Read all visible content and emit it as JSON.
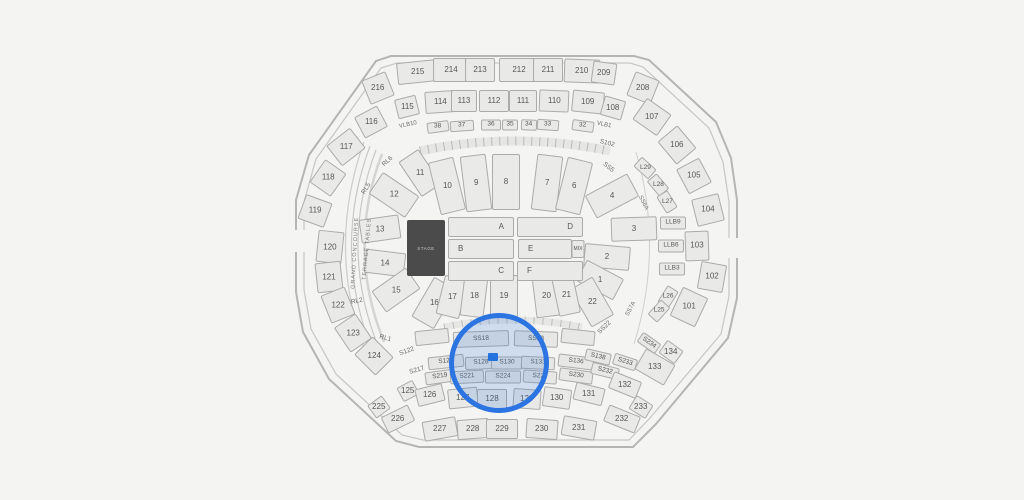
{
  "canvas": {
    "width": 1024,
    "height": 500,
    "background": "#f4f4f3"
  },
  "colors": {
    "section_fill": "#e9e9e8",
    "section_border": "#ababab",
    "label_color": "#565656",
    "stage_fill": "#4b4b4b",
    "stage_text": "#c9c9c9",
    "highlight_blue": "#2b74e2",
    "highlight_tint": "rgba(59,123,213,0.20)",
    "selected_fill": "#1e6fe3"
  },
  "map": {
    "stage": {
      "label": "STAGE",
      "x": 426,
      "y": 248,
      "w": 38,
      "h": 56
    },
    "selection": {
      "circle": {
        "cx": 494,
        "cy": 358,
        "r": 45,
        "stroke_w": 5
      },
      "marker": {
        "x": 493,
        "y": 357,
        "w": 10,
        "h": 8
      }
    },
    "sections": [
      {
        "n": "216",
        "x": 378,
        "y": 88,
        "w": 26,
        "h": 26,
        "r": -22,
        "t": "o"
      },
      {
        "n": "215",
        "x": 418,
        "y": 72,
        "w": 42,
        "h": 22,
        "r": -6,
        "t": "o"
      },
      {
        "n": "214",
        "x": 451,
        "y": 70,
        "w": 36,
        "h": 24,
        "r": 0,
        "t": "o"
      },
      {
        "n": "213",
        "x": 480,
        "y": 70,
        "w": 30,
        "h": 24,
        "r": 0,
        "t": "o"
      },
      {
        "n": "212",
        "x": 519,
        "y": 70,
        "w": 40,
        "h": 24,
        "r": 0,
        "t": "o"
      },
      {
        "n": "211",
        "x": 548,
        "y": 70,
        "w": 30,
        "h": 24,
        "r": 0,
        "t": "o"
      },
      {
        "n": "210",
        "x": 582,
        "y": 71,
        "w": 36,
        "h": 24,
        "r": 2,
        "t": "o"
      },
      {
        "n": "209",
        "x": 604,
        "y": 73,
        "w": 24,
        "h": 22,
        "r": 8,
        "t": "o"
      },
      {
        "n": "208",
        "x": 643,
        "y": 88,
        "w": 26,
        "h": 26,
        "r": 22,
        "t": "o"
      },
      {
        "n": "115",
        "x": 407,
        "y": 107,
        "w": 22,
        "h": 20,
        "r": -14,
        "t": "o"
      },
      {
        "n": "114",
        "x": 440,
        "y": 102,
        "w": 30,
        "h": 22,
        "r": -4,
        "t": "o"
      },
      {
        "n": "113",
        "x": 464,
        "y": 101,
        "w": 26,
        "h": 22,
        "r": 0,
        "t": "o"
      },
      {
        "n": "112",
        "x": 494,
        "y": 101,
        "w": 30,
        "h": 22,
        "r": 0,
        "t": "o"
      },
      {
        "n": "111",
        "x": 523,
        "y": 101,
        "w": 28,
        "h": 22,
        "r": 0,
        "t": "o"
      },
      {
        "n": "110",
        "x": 554,
        "y": 101,
        "w": 30,
        "h": 22,
        "r": 2,
        "t": "o"
      },
      {
        "n": "109",
        "x": 588,
        "y": 102,
        "w": 32,
        "h": 22,
        "r": 6,
        "t": "o"
      },
      {
        "n": "108",
        "x": 613,
        "y": 108,
        "w": 22,
        "h": 20,
        "r": 16,
        "t": "o"
      },
      {
        "n": "38",
        "x": 438,
        "y": 127,
        "w": 22,
        "h": 11,
        "r": -8,
        "t": "l"
      },
      {
        "n": "37",
        "x": 462,
        "y": 126,
        "w": 24,
        "h": 11,
        "r": -4,
        "t": "l"
      },
      {
        "n": "36",
        "x": 491,
        "y": 125,
        "w": 20,
        "h": 11,
        "r": 0,
        "t": "l"
      },
      {
        "n": "35",
        "x": 510,
        "y": 125,
        "w": 16,
        "h": 11,
        "r": 0,
        "t": "l"
      },
      {
        "n": "34",
        "x": 529,
        "y": 125,
        "w": 16,
        "h": 11,
        "r": 2,
        "t": "l"
      },
      {
        "n": "33",
        "x": 548,
        "y": 125,
        "w": 22,
        "h": 11,
        "r": 4,
        "t": "l"
      },
      {
        "n": "32",
        "x": 583,
        "y": 126,
        "w": 22,
        "h": 11,
        "r": 8,
        "t": "l"
      },
      {
        "n": "116",
        "x": 371,
        "y": 122,
        "w": 26,
        "h": 24,
        "r": -28,
        "t": "o"
      },
      {
        "n": "117",
        "x": 346,
        "y": 147,
        "w": 30,
        "h": 26,
        "r": -38,
        "t": "o"
      },
      {
        "n": "118",
        "x": 328,
        "y": 178,
        "w": 28,
        "h": 26,
        "r": -55,
        "t": "o"
      },
      {
        "n": "119",
        "x": 315,
        "y": 211,
        "w": 26,
        "h": 28,
        "r": -70,
        "t": "o"
      },
      {
        "n": "120",
        "x": 330,
        "y": 247,
        "w": 32,
        "h": 26,
        "r": -84,
        "t": "o"
      },
      {
        "n": "121",
        "x": 329,
        "y": 277,
        "w": 30,
        "h": 26,
        "r": -96,
        "t": "o"
      },
      {
        "n": "122",
        "x": 338,
        "y": 305,
        "w": 30,
        "h": 26,
        "r": -112,
        "t": "o"
      },
      {
        "n": "123",
        "x": 353,
        "y": 333,
        "w": 30,
        "h": 26,
        "r": -124,
        "t": "o"
      },
      {
        "n": "124",
        "x": 374,
        "y": 356,
        "w": 30,
        "h": 26,
        "r": -135,
        "t": "o"
      },
      {
        "n": "107",
        "x": 652,
        "y": 117,
        "w": 30,
        "h": 26,
        "r": 35,
        "t": "o"
      },
      {
        "n": "106",
        "x": 677,
        "y": 145,
        "w": 30,
        "h": 26,
        "r": 50,
        "t": "o"
      },
      {
        "n": "105",
        "x": 694,
        "y": 176,
        "w": 28,
        "h": 26,
        "r": 62,
        "t": "o"
      },
      {
        "n": "104",
        "x": 708,
        "y": 210,
        "w": 28,
        "h": 28,
        "r": 76,
        "t": "o"
      },
      {
        "n": "103",
        "x": 697,
        "y": 246,
        "w": 30,
        "h": 24,
        "r": 88,
        "t": "o"
      },
      {
        "n": "102",
        "x": 712,
        "y": 277,
        "w": 28,
        "h": 26,
        "r": 100,
        "t": "o"
      },
      {
        "n": "101",
        "x": 689,
        "y": 307,
        "w": 32,
        "h": 28,
        "r": 115,
        "t": "o"
      },
      {
        "n": "L29",
        "x": 645,
        "y": 168,
        "w": 20,
        "h": 13,
        "r": 42,
        "t": "l"
      },
      {
        "n": "L28",
        "x": 658,
        "y": 185,
        "w": 20,
        "h": 13,
        "r": 50,
        "t": "l"
      },
      {
        "n": "L27",
        "x": 667,
        "y": 202,
        "w": 20,
        "h": 13,
        "r": 58,
        "t": "l"
      },
      {
        "n": "LLB9",
        "x": 673,
        "y": 223,
        "w": 26,
        "h": 13,
        "r": 0,
        "t": "l"
      },
      {
        "n": "LLB6",
        "x": 671,
        "y": 246,
        "w": 26,
        "h": 13,
        "r": 0,
        "t": "l"
      },
      {
        "n": "LLB3",
        "x": 672,
        "y": 269,
        "w": 26,
        "h": 13,
        "r": 0,
        "t": "l"
      },
      {
        "n": "L26",
        "x": 668,
        "y": 297,
        "w": 20,
        "h": 13,
        "r": -58,
        "t": "l"
      },
      {
        "n": "L25",
        "x": 659,
        "y": 311,
        "w": 20,
        "h": 13,
        "r": -48,
        "t": "l"
      },
      {
        "n": "11",
        "x": 420,
        "y": 173,
        "w": 24,
        "h": 42,
        "r": -34,
        "t": "i"
      },
      {
        "n": "12",
        "x": 394,
        "y": 195,
        "w": 26,
        "h": 44,
        "r": -56,
        "t": "i"
      },
      {
        "n": "13",
        "x": 380,
        "y": 229,
        "w": 24,
        "h": 40,
        "r": 82,
        "t": "i"
      },
      {
        "n": "14",
        "x": 385,
        "y": 263,
        "w": 24,
        "h": 40,
        "r": 97,
        "t": "i"
      },
      {
        "n": "15",
        "x": 396,
        "y": 290,
        "w": 26,
        "h": 42,
        "r": 55,
        "t": "i"
      },
      {
        "n": "16",
        "x": 434,
        "y": 303,
        "w": 26,
        "h": 46,
        "r": 30,
        "t": "i"
      },
      {
        "n": "10",
        "x": 447,
        "y": 186,
        "w": 26,
        "h": 54,
        "r": -14,
        "t": "i"
      },
      {
        "n": "9",
        "x": 476,
        "y": 183,
        "w": 26,
        "h": 56,
        "r": -7,
        "t": "i"
      },
      {
        "n": "8",
        "x": 506,
        "y": 182,
        "w": 28,
        "h": 56,
        "r": 0,
        "t": "i"
      },
      {
        "n": "7",
        "x": 547,
        "y": 183,
        "w": 26,
        "h": 56,
        "r": 7,
        "t": "i"
      },
      {
        "n": "6",
        "x": 574,
        "y": 186,
        "w": 26,
        "h": 54,
        "r": 14,
        "t": "i"
      },
      {
        "n": "4",
        "x": 612,
        "y": 196,
        "w": 26,
        "h": 48,
        "r": 62,
        "t": "i"
      },
      {
        "n": "3",
        "x": 634,
        "y": 229,
        "w": 24,
        "h": 46,
        "r": -92,
        "t": "i"
      },
      {
        "n": "2",
        "x": 607,
        "y": 257,
        "w": 24,
        "h": 46,
        "r": -85,
        "t": "i"
      },
      {
        "n": "1",
        "x": 600,
        "y": 280,
        "w": 24,
        "h": 42,
        "r": -62,
        "t": "i"
      },
      {
        "n": "22",
        "x": 592,
        "y": 302,
        "w": 26,
        "h": 44,
        "r": -30,
        "t": "i"
      },
      {
        "n": "17",
        "x": 452,
        "y": 297,
        "w": 24,
        "h": 40,
        "r": 14,
        "t": "i"
      },
      {
        "n": "18",
        "x": 474,
        "y": 296,
        "w": 24,
        "h": 42,
        "r": 7,
        "t": "i"
      },
      {
        "n": "19",
        "x": 504,
        "y": 296,
        "w": 28,
        "h": 42,
        "r": 0,
        "t": "i"
      },
      {
        "n": "20",
        "x": 546,
        "y": 296,
        "w": 24,
        "h": 42,
        "r": -7,
        "t": "i"
      },
      {
        "n": "21",
        "x": 566,
        "y": 295,
        "w": 22,
        "h": 40,
        "r": -12,
        "t": "i"
      },
      {
        "n": "A",
        "x": 481,
        "y": 227,
        "w": 66,
        "h": 20,
        "r": 0,
        "t": "f",
        "al": "r"
      },
      {
        "n": "D",
        "x": 550,
        "y": 227,
        "w": 66,
        "h": 20,
        "r": 0,
        "t": "f",
        "al": "r"
      },
      {
        "n": "B",
        "x": 481,
        "y": 249,
        "w": 66,
        "h": 20,
        "r": 0,
        "t": "f",
        "al": "l"
      },
      {
        "n": "E",
        "x": 545,
        "y": 249,
        "w": 54,
        "h": 20,
        "r": 0,
        "t": "f",
        "al": "l"
      },
      {
        "n": "MIX",
        "x": 578,
        "y": 249,
        "w": 13,
        "h": 18,
        "r": 0,
        "t": "m"
      },
      {
        "n": "C",
        "x": 481,
        "y": 271,
        "w": 66,
        "h": 20,
        "r": 0,
        "t": "f",
        "al": "r"
      },
      {
        "n": "F",
        "x": 550,
        "y": 271,
        "w": 66,
        "h": 20,
        "r": 0,
        "t": "f",
        "al": "l"
      },
      {
        "n": "",
        "x": 432,
        "y": 337,
        "w": 34,
        "h": 15,
        "r": -6,
        "t": "s"
      },
      {
        "n": "SS18",
        "x": 481,
        "y": 339,
        "w": 56,
        "h": 16,
        "r": -2,
        "t": "s"
      },
      {
        "n": "SS18",
        "x": 536,
        "y": 339,
        "w": 44,
        "h": 16,
        "r": 2,
        "t": "s"
      },
      {
        "n": "",
        "x": 578,
        "y": 337,
        "w": 34,
        "h": 15,
        "r": 6,
        "t": "s"
      },
      {
        "n": "S125",
        "x": 446,
        "y": 362,
        "w": 36,
        "h": 13,
        "r": -6,
        "t": "s"
      },
      {
        "n": "S128",
        "x": 481,
        "y": 363,
        "w": 32,
        "h": 13,
        "r": -2,
        "t": "s"
      },
      {
        "n": "S130",
        "x": 507,
        "y": 363,
        "w": 32,
        "h": 13,
        "r": 0,
        "t": "s"
      },
      {
        "n": "S133",
        "x": 538,
        "y": 363,
        "w": 34,
        "h": 13,
        "r": 3,
        "t": "s"
      },
      {
        "n": "S136",
        "x": 576,
        "y": 362,
        "w": 36,
        "h": 13,
        "r": 7,
        "t": "s"
      },
      {
        "n": "S138",
        "x": 598,
        "y": 357,
        "w": 26,
        "h": 12,
        "r": 13,
        "t": "s"
      },
      {
        "n": "S233",
        "x": 625,
        "y": 362,
        "w": 24,
        "h": 12,
        "r": 18,
        "t": "s"
      },
      {
        "n": "S234",
        "x": 649,
        "y": 343,
        "w": 22,
        "h": 12,
        "r": 35,
        "t": "s"
      },
      {
        "n": "S219",
        "x": 440,
        "y": 377,
        "w": 30,
        "h": 13,
        "r": -8,
        "t": "s"
      },
      {
        "n": "S221",
        "x": 467,
        "y": 377,
        "w": 34,
        "h": 13,
        "r": -3,
        "t": "s"
      },
      {
        "n": "S224",
        "x": 503,
        "y": 377,
        "w": 36,
        "h": 13,
        "r": 0,
        "t": "s"
      },
      {
        "n": "S227",
        "x": 540,
        "y": 377,
        "w": 34,
        "h": 13,
        "r": 4,
        "t": "s"
      },
      {
        "n": "S230",
        "x": 576,
        "y": 376,
        "w": 34,
        "h": 13,
        "r": 8,
        "t": "s"
      },
      {
        "n": "S232",
        "x": 605,
        "y": 371,
        "w": 28,
        "h": 12,
        "r": 14,
        "t": "s"
      },
      {
        "n": "125",
        "x": 408,
        "y": 391,
        "w": 18,
        "h": 16,
        "r": -28,
        "t": "o"
      },
      {
        "n": "126",
        "x": 430,
        "y": 395,
        "w": 28,
        "h": 18,
        "r": -14,
        "t": "o"
      },
      {
        "n": "127",
        "x": 463,
        "y": 398,
        "w": 30,
        "h": 20,
        "r": -6,
        "t": "o"
      },
      {
        "n": "128",
        "x": 492,
        "y": 399,
        "w": 30,
        "h": 20,
        "r": 0,
        "t": "o"
      },
      {
        "n": "129",
        "x": 527,
        "y": 399,
        "w": 28,
        "h": 20,
        "r": 4,
        "t": "o"
      },
      {
        "n": "130",
        "x": 557,
        "y": 398,
        "w": 28,
        "h": 20,
        "r": 8,
        "t": "o"
      },
      {
        "n": "131",
        "x": 589,
        "y": 394,
        "w": 30,
        "h": 18,
        "r": 14,
        "t": "o"
      },
      {
        "n": "132",
        "x": 625,
        "y": 385,
        "w": 30,
        "h": 18,
        "r": 22,
        "t": "o"
      },
      {
        "n": "133",
        "x": 655,
        "y": 367,
        "w": 34,
        "h": 24,
        "r": 30,
        "t": "o"
      },
      {
        "n": "134",
        "x": 671,
        "y": 352,
        "w": 20,
        "h": 16,
        "r": 36,
        "t": "o"
      },
      {
        "n": "225",
        "x": 379,
        "y": 407,
        "w": 18,
        "h": 16,
        "r": -36,
        "t": "o"
      },
      {
        "n": "226",
        "x": 398,
        "y": 419,
        "w": 30,
        "h": 18,
        "r": -26,
        "t": "o"
      },
      {
        "n": "227",
        "x": 440,
        "y": 429,
        "w": 34,
        "h": 20,
        "r": -10,
        "t": "o"
      },
      {
        "n": "228",
        "x": 473,
        "y": 429,
        "w": 32,
        "h": 20,
        "r": -4,
        "t": "o"
      },
      {
        "n": "229",
        "x": 502,
        "y": 429,
        "w": 32,
        "h": 20,
        "r": 0,
        "t": "o"
      },
      {
        "n": "230",
        "x": 542,
        "y": 429,
        "w": 32,
        "h": 20,
        "r": 4,
        "t": "o"
      },
      {
        "n": "231",
        "x": 579,
        "y": 428,
        "w": 34,
        "h": 20,
        "r": 10,
        "t": "o"
      },
      {
        "n": "232",
        "x": 622,
        "y": 419,
        "w": 34,
        "h": 18,
        "r": 22,
        "t": "o"
      },
      {
        "n": "233",
        "x": 641,
        "y": 407,
        "w": 20,
        "h": 16,
        "r": 32,
        "t": "o"
      }
    ],
    "labels": [
      {
        "n": "VLB10",
        "x": 408,
        "y": 125,
        "r": -12,
        "fs": 6
      },
      {
        "n": "VLB1",
        "x": 604,
        "y": 125,
        "r": 12,
        "fs": 6
      },
      {
        "n": "S102",
        "x": 607,
        "y": 144,
        "r": 14,
        "fs": 6.5
      },
      {
        "n": "SS5",
        "x": 608,
        "y": 168,
        "r": 38,
        "fs": 6.5
      },
      {
        "n": "SS6A",
        "x": 643,
        "y": 203,
        "r": 64,
        "fs": 6
      },
      {
        "n": "SS7A",
        "x": 631,
        "y": 309,
        "r": -62,
        "fs": 6
      },
      {
        "n": "SS22",
        "x": 605,
        "y": 328,
        "r": -44,
        "fs": 6.5
      },
      {
        "n": "S122",
        "x": 407,
        "y": 352,
        "r": -20,
        "fs": 6.5
      },
      {
        "n": "S217",
        "x": 417,
        "y": 371,
        "r": -16,
        "fs": 6.5
      },
      {
        "n": "RL6",
        "x": 388,
        "y": 162,
        "r": -42,
        "fs": 6.5
      },
      {
        "n": "RL5",
        "x": 367,
        "y": 189,
        "r": -58,
        "fs": 6.5
      },
      {
        "n": "RL2",
        "x": 357,
        "y": 302,
        "r": -12,
        "fs": 6.5
      },
      {
        "n": "RL1",
        "x": 385,
        "y": 339,
        "r": 15,
        "fs": 6.5
      },
      {
        "n": "GRAND CONCOURSE",
        "x": 356,
        "y": 253,
        "r": -87,
        "fs": 5.5,
        "cls": "concourse"
      },
      {
        "n": "TERRACE TABLES",
        "x": 368,
        "y": 249,
        "r": -85,
        "fs": 5.5,
        "cls": "concourse"
      }
    ]
  }
}
